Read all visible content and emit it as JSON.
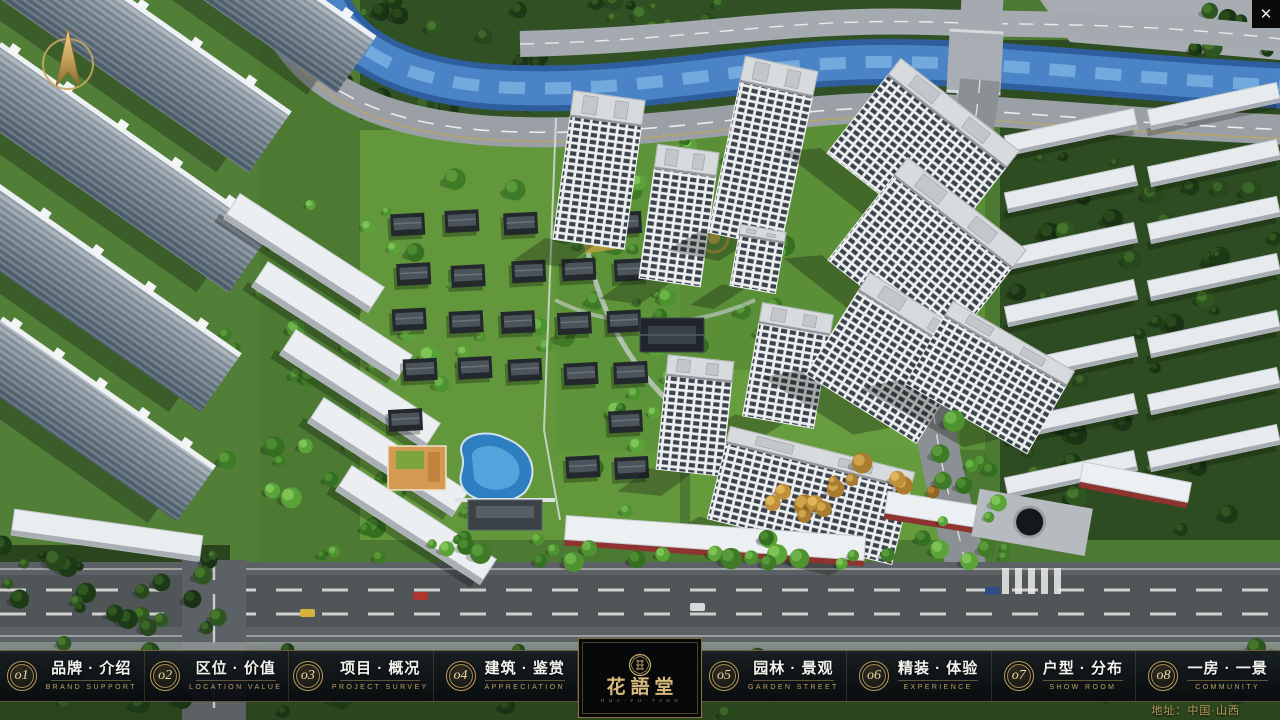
{
  "window": {
    "close_label": "✕"
  },
  "nav": {
    "items": [
      {
        "num": "o1",
        "title": "品牌 · 介绍",
        "subtitle": "BRAND SUPPORT"
      },
      {
        "num": "o2",
        "title": "区位 · 价值",
        "subtitle": "LOCATION VALUE"
      },
      {
        "num": "o3",
        "title": "项目 · 概况",
        "subtitle": "PROJECT SURVEY"
      },
      {
        "num": "o4",
        "title": "建筑 · 鉴赏",
        "subtitle": "APPRECIATION"
      },
      {
        "num": "o5",
        "title": "园林 · 景观",
        "subtitle": "GARDEN STREET"
      },
      {
        "num": "o6",
        "title": "精装 · 体验",
        "subtitle": "EXPERIENCE"
      },
      {
        "num": "o7",
        "title": "户型 · 分布",
        "subtitle": "SHOW ROOM"
      },
      {
        "num": "o8",
        "title": "一房 · 一景",
        "subtitle": "COMMUNITY"
      }
    ]
  },
  "logo": {
    "title": "花語堂",
    "subtitle": "H U A · Y U · T A N G"
  },
  "footer": {
    "address": "地址：中国·山西"
  },
  "icons": {
    "close": "close-icon",
    "compass": "compass-north-arrow",
    "seal": "project-seal-icon"
  },
  "colors": {
    "gold": "#c8a867",
    "gold_dim": "#9c8650",
    "bar_bg": "rgba(9,13,18,0.92)",
    "panel_bg": "#060809",
    "title_text": "#f3f3ee",
    "river": "#4a84c6"
  }
}
